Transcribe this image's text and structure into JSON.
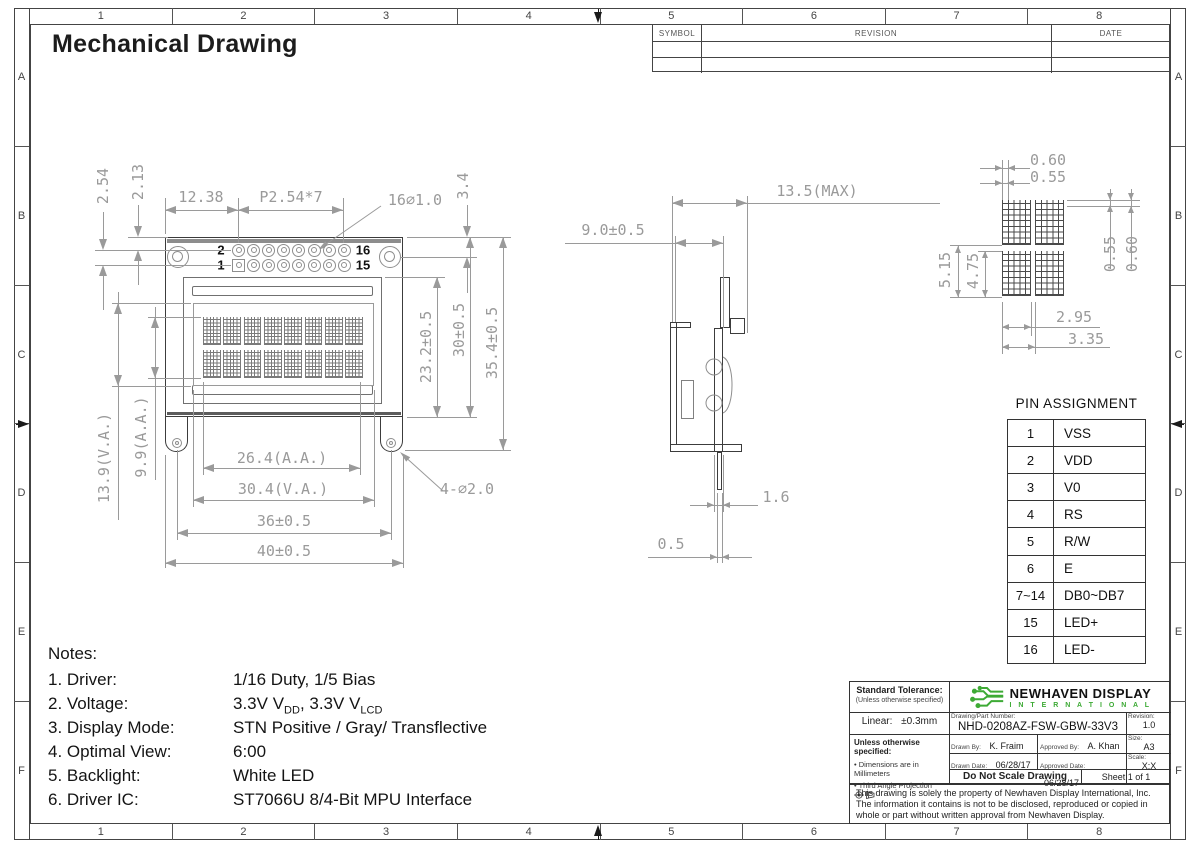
{
  "page": {
    "title": "Mechanical Drawing"
  },
  "border": {
    "columns": [
      "1",
      "2",
      "3",
      "4",
      "5",
      "6",
      "7",
      "8"
    ],
    "rows": [
      "A",
      "B",
      "C",
      "D",
      "E",
      "F"
    ]
  },
  "revision_table": {
    "headers": [
      "SYMBOL",
      "REVISION",
      "DATE"
    ]
  },
  "front_view": {
    "pin_labels": {
      "first": "1",
      "second": "2",
      "fifteenth": "15",
      "sixteenth": "16"
    },
    "dims": {
      "pin_pitch_v": "2.54",
      "pin_top_offset": "2.13",
      "pin_offset_x": "12.38",
      "pin_pitch_x": "P2.54*7",
      "pin_holes": "16∅1.0",
      "hole_top_offset": "3.4",
      "bezel_height": "23.2±0.5",
      "body_height": "30±0.5",
      "overall_height": "35.4±0.5",
      "va_height": "13.9(V.A.)",
      "aa_height": "9.9(A.A.)",
      "aa_width": "26.4(A.A.)",
      "va_width": "30.4(V.A.)",
      "mount_width": "36±0.5",
      "body_width": "40±0.5",
      "mount_holes": "4-∅2.0"
    }
  },
  "side_view": {
    "dims": {
      "max_depth": "13.5(MAX)",
      "depth": "9.0±0.5",
      "pcb": "1.6",
      "pin": "0.5"
    }
  },
  "char_detail": {
    "dims": {
      "dot_pitch_x": "0.60",
      "dot_width": "0.55",
      "dot_height": "0.55",
      "dot_pitch_y": "0.60",
      "row_pitch": "5.15",
      "char_height": "4.75",
      "char_width": "2.95",
      "char_pitch": "3.35"
    }
  },
  "pin_table": {
    "title": "PIN ASSIGNMENT",
    "rows": [
      [
        "1",
        "VSS"
      ],
      [
        "2",
        "VDD"
      ],
      [
        "3",
        "V0"
      ],
      [
        "4",
        "RS"
      ],
      [
        "5",
        "R/W"
      ],
      [
        "6",
        "E"
      ],
      [
        "7~14",
        "DB0~DB7"
      ],
      [
        "15",
        "LED+"
      ],
      [
        "16",
        "LED-"
      ]
    ]
  },
  "notes": {
    "heading": "Notes:",
    "items": [
      {
        "label": "1. Driver:",
        "value": "1/16 Duty, 1/5 Bias"
      },
      {
        "label": "2. Voltage:",
        "value_parts": [
          {
            "t": "3.3V V"
          },
          {
            "s": "DD"
          },
          {
            "t": ", 3.3V V"
          },
          {
            "s": "LCD"
          }
        ]
      },
      {
        "label": "3. Display Mode:",
        "value": "STN Positive / Gray/ Transflective"
      },
      {
        "label": "4. Optimal View:",
        "value": "6:00"
      },
      {
        "label": "5. Backlight:",
        "value": "White LED"
      },
      {
        "label": "6. Driver IC:",
        "value": "ST7066U 8/4-Bit MPU Interface"
      }
    ]
  },
  "title_block": {
    "standard_tolerance_title": "Standard Tolerance:",
    "standard_tolerance_sub": "(Unless otherwise specified)",
    "linear_label": "Linear:",
    "linear_value": "±0.3mm",
    "unless_title": "Unless otherwise specified:",
    "bullet1": "Dimensions are in Millimeters",
    "bullet2": "Third Angle Projection",
    "company_name": "NEWHAVEN DISPLAY",
    "company_sub": "I N T E R N A T I O N A L",
    "part_label": "Drawing/Part Number:",
    "part_number": "NHD-0208AZ-FSW-GBW-33V3",
    "revision_label": "Revision:",
    "revision": "1.0",
    "size_label": "Size:",
    "size": "A3",
    "scale_label": "Scale:",
    "scale": "X:X",
    "drawn_by_label": "Drawn By:",
    "drawn_by": "K. Fraim",
    "approved_by_label": "Approved By:",
    "approved_by": "A. Khan",
    "drawn_date_label": "Drawn Date:",
    "drawn_date": "06/28/17",
    "approved_date_label": "Approved Date:",
    "approved_date": "06/28/17",
    "do_not_scale": "Do Not Scale Drawing",
    "sheet": "Sheet 1 of 1",
    "disclaimer1": "This drawing is solely the property of Newhaven Display International, Inc.",
    "disclaimer2": "The information it contains is not to be disclosed, reproduced or copied in",
    "disclaimer3": "whole or part without written approval from Newhaven Display."
  },
  "colors": {
    "line_gray": "#9a9a9a",
    "dark_line": "#3c3c3c",
    "logo_green": "#3daa35"
  }
}
